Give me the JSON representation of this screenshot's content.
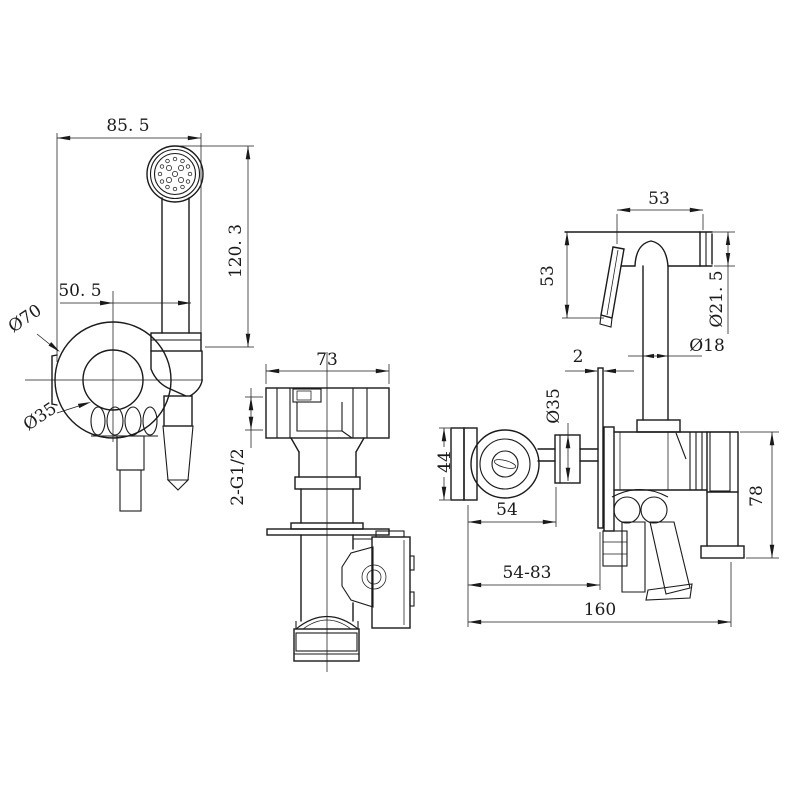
{
  "page": {
    "background": "#ffffff",
    "line_color": "#1a1a1a"
  },
  "views": {
    "front": {
      "dims": {
        "width": "85. 5",
        "height": "120. 3",
        "offset": "50. 5",
        "flange_outer_dia": "Ø70",
        "flange_inner_dia": "Ø35"
      }
    },
    "tee": {
      "dims": {
        "width": "73",
        "threads": "2-G1/2"
      }
    },
    "side": {
      "dims": {
        "head_length": "53",
        "head_height": "53",
        "head_dia": "Ø21. 5",
        "handle_dia": "Ø18",
        "wall_plate_thickness": "2",
        "escutcheon_dia": "Ø35",
        "holder_height": "44",
        "holder_offset": "54",
        "valve_height": "78",
        "depth_range": "54-83",
        "overall_depth": "160"
      }
    }
  }
}
